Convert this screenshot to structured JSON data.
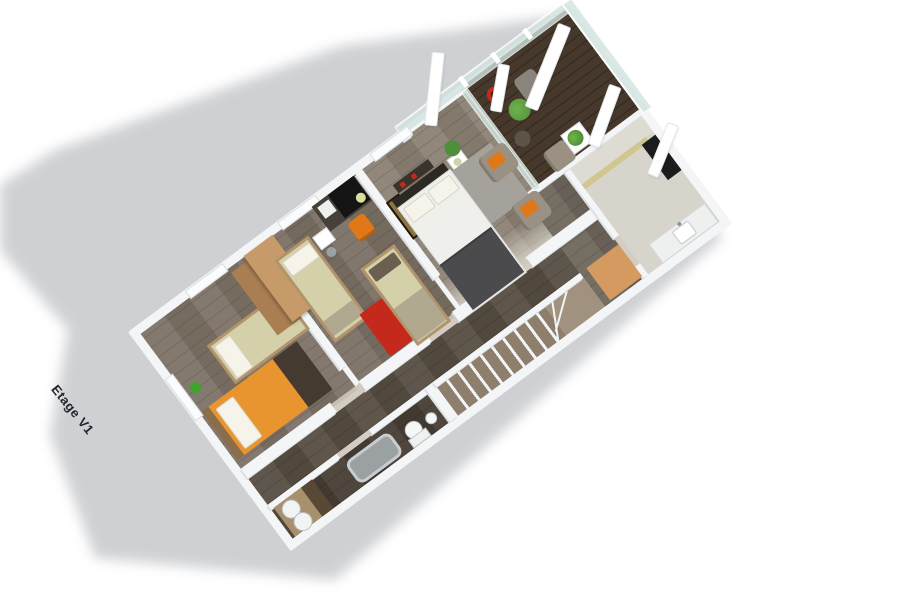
{
  "label": {
    "floor": "Etage V1"
  },
  "palette": {
    "wall": "#f3f5f6",
    "wallShade": "#dbe1e4",
    "floorKids": "#7d7266",
    "floorMiddle": "#7b7064",
    "floorMaster": "#8b8174",
    "corridor": "#564d42",
    "hall": "#6e665b",
    "deck": "#46392c",
    "bathBottom": "#463d34",
    "counterWood": "#5a4836",
    "counterTop": "#a8906d",
    "bathRight": "#d7d4cb",
    "shower": "#dedbd2",
    "showerGlass": "#cfc78f",
    "stairWood": "#8d7f6c",
    "landing": "#a19280",
    "cream": "#d4d0a9",
    "creamFrame": "#b1946c",
    "orangeBed": "#e8952f",
    "orangeChair": "#e07818",
    "woodTan": "#c79a6a",
    "woodTanSide": "#a87e52",
    "woodDark": "#443a30",
    "headboardTan": "#8a6d4a",
    "red": "#c4291c",
    "rugGray": "#a4a29b",
    "charcoal": "#4b4b4d",
    "duvet": "#efefec",
    "headboard": "#2c2823",
    "black": "#141414",
    "deskGray": "#464038",
    "taupe": "#9a9183",
    "green": "#4e8f3a",
    "greenBright": "#3fa32e",
    "glass": "#d2e4e0",
    "tub": "#9ba1a3",
    "tubRim": "#c9cdcf",
    "mirror": "#1b1c1e",
    "tan": "#d59a5f",
    "offWhite": "#eef0ef",
    "pillow": "#f6f4ea",
    "blanketTaupe": "#b0a98f",
    "artGold": "#8a7442",
    "shadow": "#cbcdd0",
    "label": "#23242a"
  }
}
